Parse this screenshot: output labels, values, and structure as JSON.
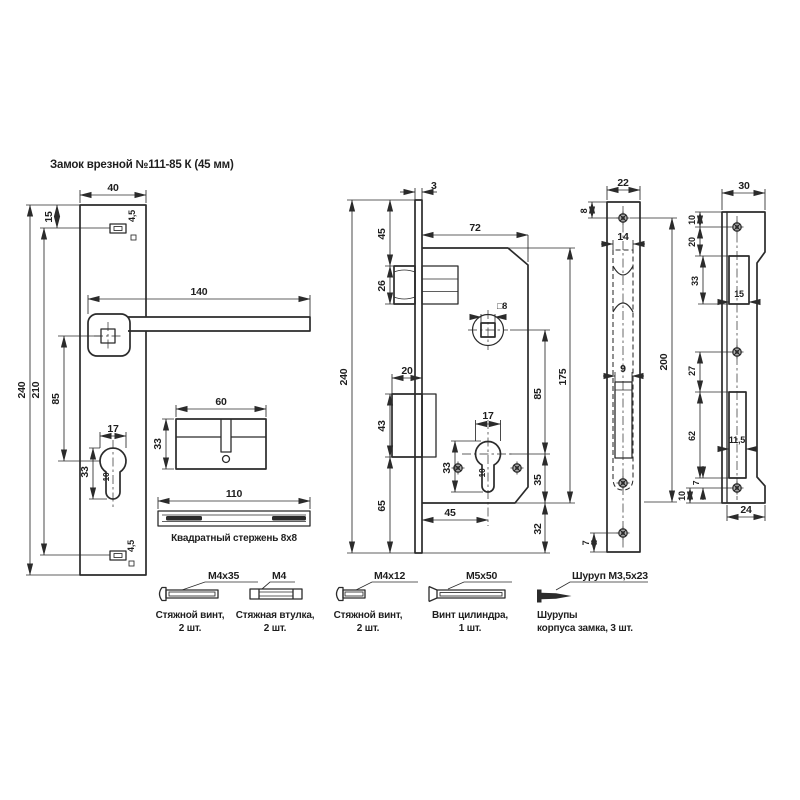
{
  "title": "Замок врезной №111-85 К (45 мм)",
  "colors": {
    "line": "#2b2b2b",
    "text": "#1f1f1f",
    "background": "#ffffff"
  },
  "handle_plate": {
    "width": "40",
    "top_hole_offset": "15",
    "height": "240",
    "holes_span": "210",
    "handle_to_keyhole": "85",
    "handle_length": "140",
    "keyhole_width": "17",
    "keyhole_height": "33",
    "keyhole_stem": "10",
    "top_hole_size": "4,5",
    "bottom_hole_size": "4,5"
  },
  "cylinder": {
    "length": "60",
    "height": "33"
  },
  "spindle": {
    "length": "110",
    "caption": "Квадратный стержень 8х8"
  },
  "lock_body": {
    "faceplate_thickness": "3",
    "faceplate_height": "240",
    "top_to_latch": "45",
    "latch_height": "26",
    "body_width": "72",
    "spindle_hole": "□8",
    "bolt_throw": "20",
    "bolt_height": "43",
    "bolt_to_bottom": "65",
    "cylinder_width": "17",
    "cylinder_height": "33",
    "cylinder_stem": "10",
    "backset": "45",
    "centers_distance": "85",
    "body_height": "175",
    "cylinder_to_bottom": "35",
    "bottom_margin": "32"
  },
  "faceplate": {
    "width": "22",
    "top_screw_offset": "8",
    "body_slot_width": "14",
    "length": "200",
    "bolt_slot_width": "9",
    "bottom_screw_offset": "7"
  },
  "strike_plate": {
    "width": "30",
    "top_screw_offset": "10",
    "screw_to_latch_cut": "20",
    "latch_cut_height": "33",
    "latch_cut_width": "15",
    "screw_to_bolt_cut": "27",
    "bolt_cut_height": "62",
    "bolt_cut_width": "11,5",
    "cut_to_screw": "7",
    "screw_to_bottom": "10",
    "bottom_width": "24"
  },
  "hardware": [
    {
      "spec": "М4х35",
      "caption1": "Стяжной винт,",
      "caption2": "2 шт."
    },
    {
      "spec": "М4",
      "caption1": "Стяжная втулка,",
      "caption2": "2 шт."
    },
    {
      "spec": "М4х12",
      "caption1": "Стяжной винт,",
      "caption2": "2 шт."
    },
    {
      "spec": "М5х50",
      "caption1": "Винт цилиндра,",
      "caption2": "1 шт."
    },
    {
      "spec": "Шуруп М3,5х23",
      "caption1": "Шурупы",
      "caption2": "корпуса замка, 3 шт."
    }
  ]
}
